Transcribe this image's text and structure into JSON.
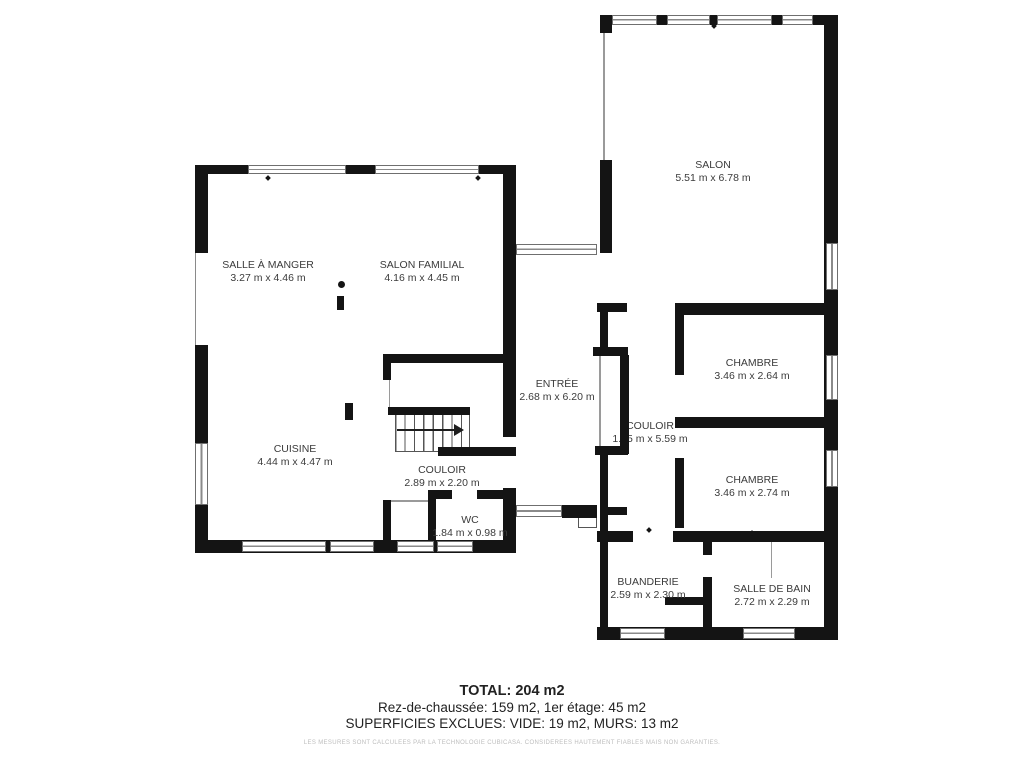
{
  "rooms": {
    "salon": {
      "name": "SALON",
      "dims": "5.51 m x 6.78 m"
    },
    "salle_a_manger": {
      "name": "SALLE À MANGER",
      "dims": "3.27 m x 4.46 m"
    },
    "salon_familial": {
      "name": "SALON FAMILIAL",
      "dims": "4.16 m x 4.45 m"
    },
    "entree": {
      "name": "ENTRÉE",
      "dims": "2.68 m x 6.20 m"
    },
    "cuisine": {
      "name": "CUISINE",
      "dims": "4.44 m x 4.47 m"
    },
    "couloir_ouest": {
      "name": "COULOIR",
      "dims": "2.89 m x 2.20 m"
    },
    "wc": {
      "name": "WC",
      "dims": "1.84 m x 0.98 m"
    },
    "couloir_est": {
      "name": "COULOIR",
      "dims": "1.15 m x 5.59 m"
    },
    "chambre_1": {
      "name": "CHAMBRE",
      "dims": "3.46 m x 2.64 m"
    },
    "chambre_2": {
      "name": "CHAMBRE",
      "dims": "3.46 m x 2.74 m"
    },
    "buanderie": {
      "name": "BUANDERIE",
      "dims": "2.59 m x 2.30 m"
    },
    "salle_de_bain": {
      "name": "SALLE DE BAIN",
      "dims": "2.72 m x 2.29 m"
    }
  },
  "summary": {
    "total": "TOTAL: 204 m2",
    "floors": "Rez-de-chaussée: 159 m2, 1er étage: 45 m2",
    "excluded": "SUPERFICIES EXCLUES: VIDE: 19 m2, MURS: 13 m2",
    "disclaimer": "LES MESURES SONT CALCULEES PAR LA TECHNOLOGIE CUBICASA. CONSIDEREES HAUTEMENT FIABLES MAIS NON GARANTIES."
  },
  "colors": {
    "wall": "#141414",
    "label_text": "#3b3b3b",
    "window_frame": "#6f6f6f",
    "disclaimer_text": "#bdbdbd"
  }
}
